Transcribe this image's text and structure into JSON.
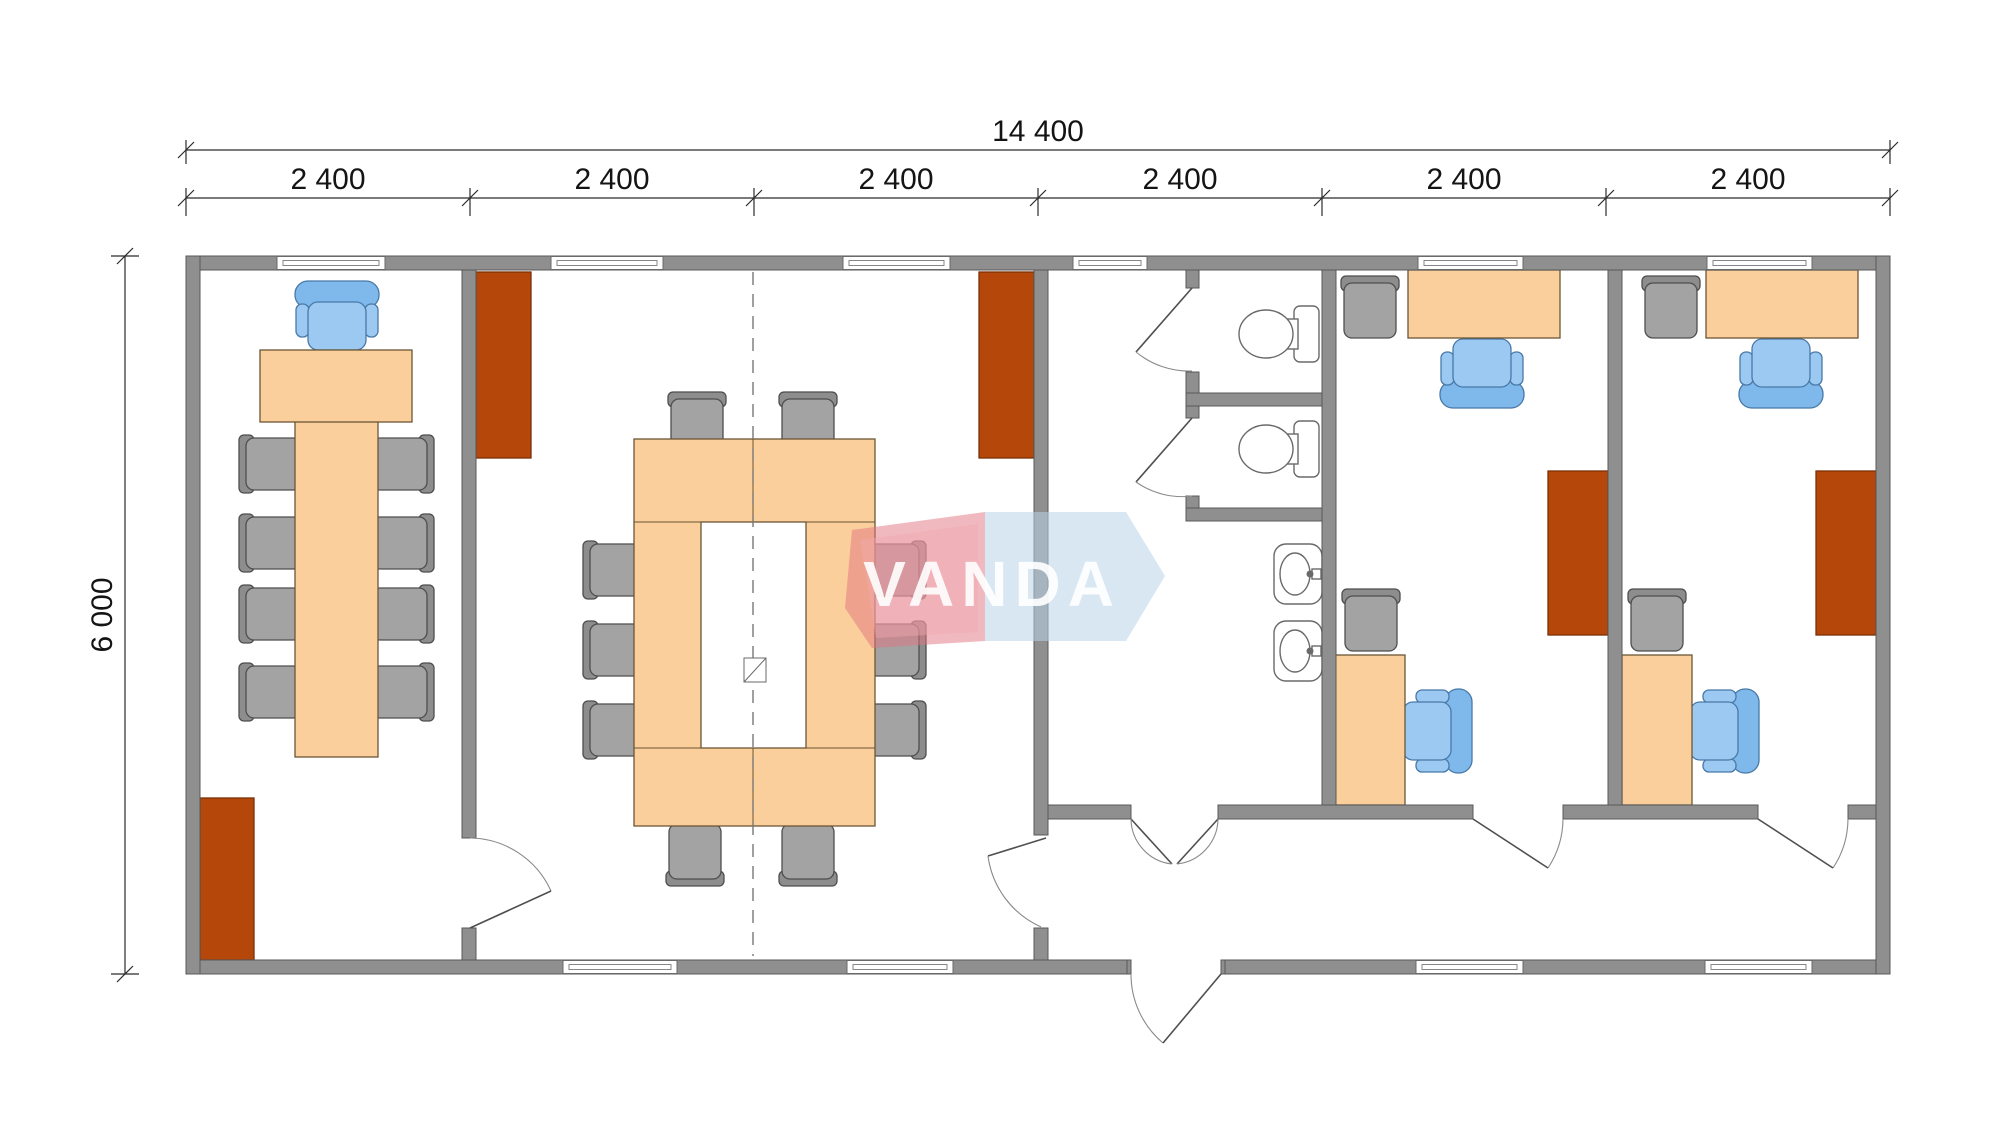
{
  "drawing": {
    "kind": "modular-office-floor-plan",
    "watermark": {
      "text": "VANDA",
      "red": "#e2737f",
      "blue": "#b9d4ea",
      "text_color": "#ffffff"
    },
    "dimensions": {
      "total_width": "14 400",
      "total_height": "6 000",
      "modules": [
        "2 400",
        "2 400",
        "2 400",
        "2 400",
        "2 400",
        "2 400"
      ]
    },
    "palette": {
      "wall": "#8f8f8f",
      "wall_stroke": "#595959",
      "desk": "#fbcf9b",
      "wardrobe": "#b5470b",
      "chair_gray": "#a3a3a3",
      "chair_blue": "#9cc9f1",
      "background": "#ffffff"
    },
    "rooms": [
      {
        "id": "meeting-room-left",
        "fixtures": {
          "desks": 2,
          "blue_chairs": 1,
          "gray_chairs": 8,
          "wardrobes": 1,
          "windows": 1
        }
      },
      {
        "id": "conference-room",
        "fixtures": {
          "ring_table": 1,
          "gray_chairs": 10,
          "wardrobes": 2,
          "windows": 4
        }
      },
      {
        "id": "wc-zone",
        "fixtures": {
          "toilet_stalls": 2,
          "toilets": 2,
          "sinks": 2,
          "windows": 1
        }
      },
      {
        "id": "office-1",
        "fixtures": {
          "desks": 2,
          "blue_chairs": 2,
          "gray_chairs": 2,
          "wardrobes": 1,
          "windows": 2
        }
      },
      {
        "id": "office-2",
        "fixtures": {
          "desks": 2,
          "blue_chairs": 2,
          "gray_chairs": 2,
          "wardrobes": 1,
          "windows": 2
        }
      },
      {
        "id": "entrance-hall",
        "fixtures": {
          "entrance_doors": 1
        }
      }
    ]
  }
}
